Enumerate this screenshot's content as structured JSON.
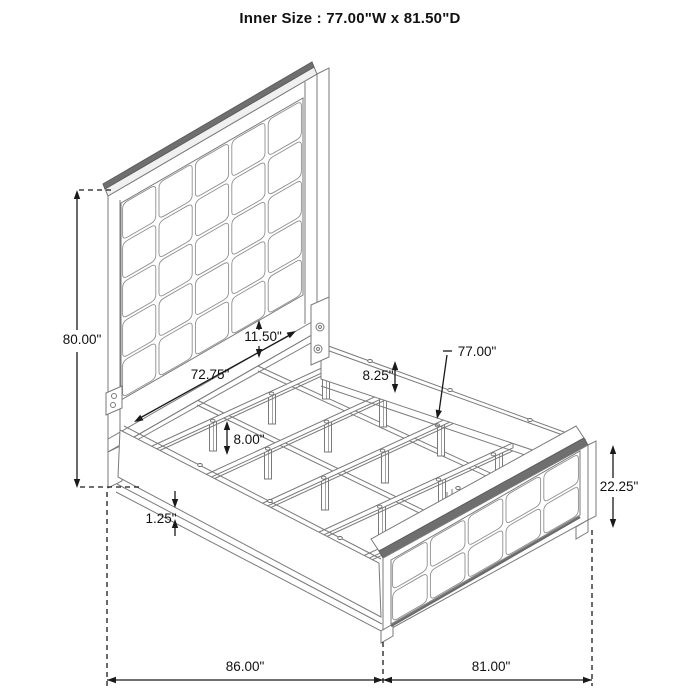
{
  "title": "Inner Size : 77.00\"W x 81.50\"D",
  "diagram": "bed-frame-dimension-drawing",
  "dimensions": {
    "headboard_height": "80.00\"",
    "headboard_inner_width": "72.75\"",
    "panel_gap": "11.50\"",
    "rail_height": "8.25\"",
    "slat_width": "77.00\"",
    "leg_height": "8.00\"",
    "rail_lip": "1.25\"",
    "footboard_height": "22.25\"",
    "overall_depth": "86.00\"",
    "overall_width": "81.00\""
  },
  "colors": {
    "line": "#7a7a7a",
    "line_dark": "#6f6f6f",
    "cell_line": "#8f8f8f",
    "dim": "#1a1a1a",
    "light_fill": "#f0f0f0",
    "background": "#ffffff"
  }
}
